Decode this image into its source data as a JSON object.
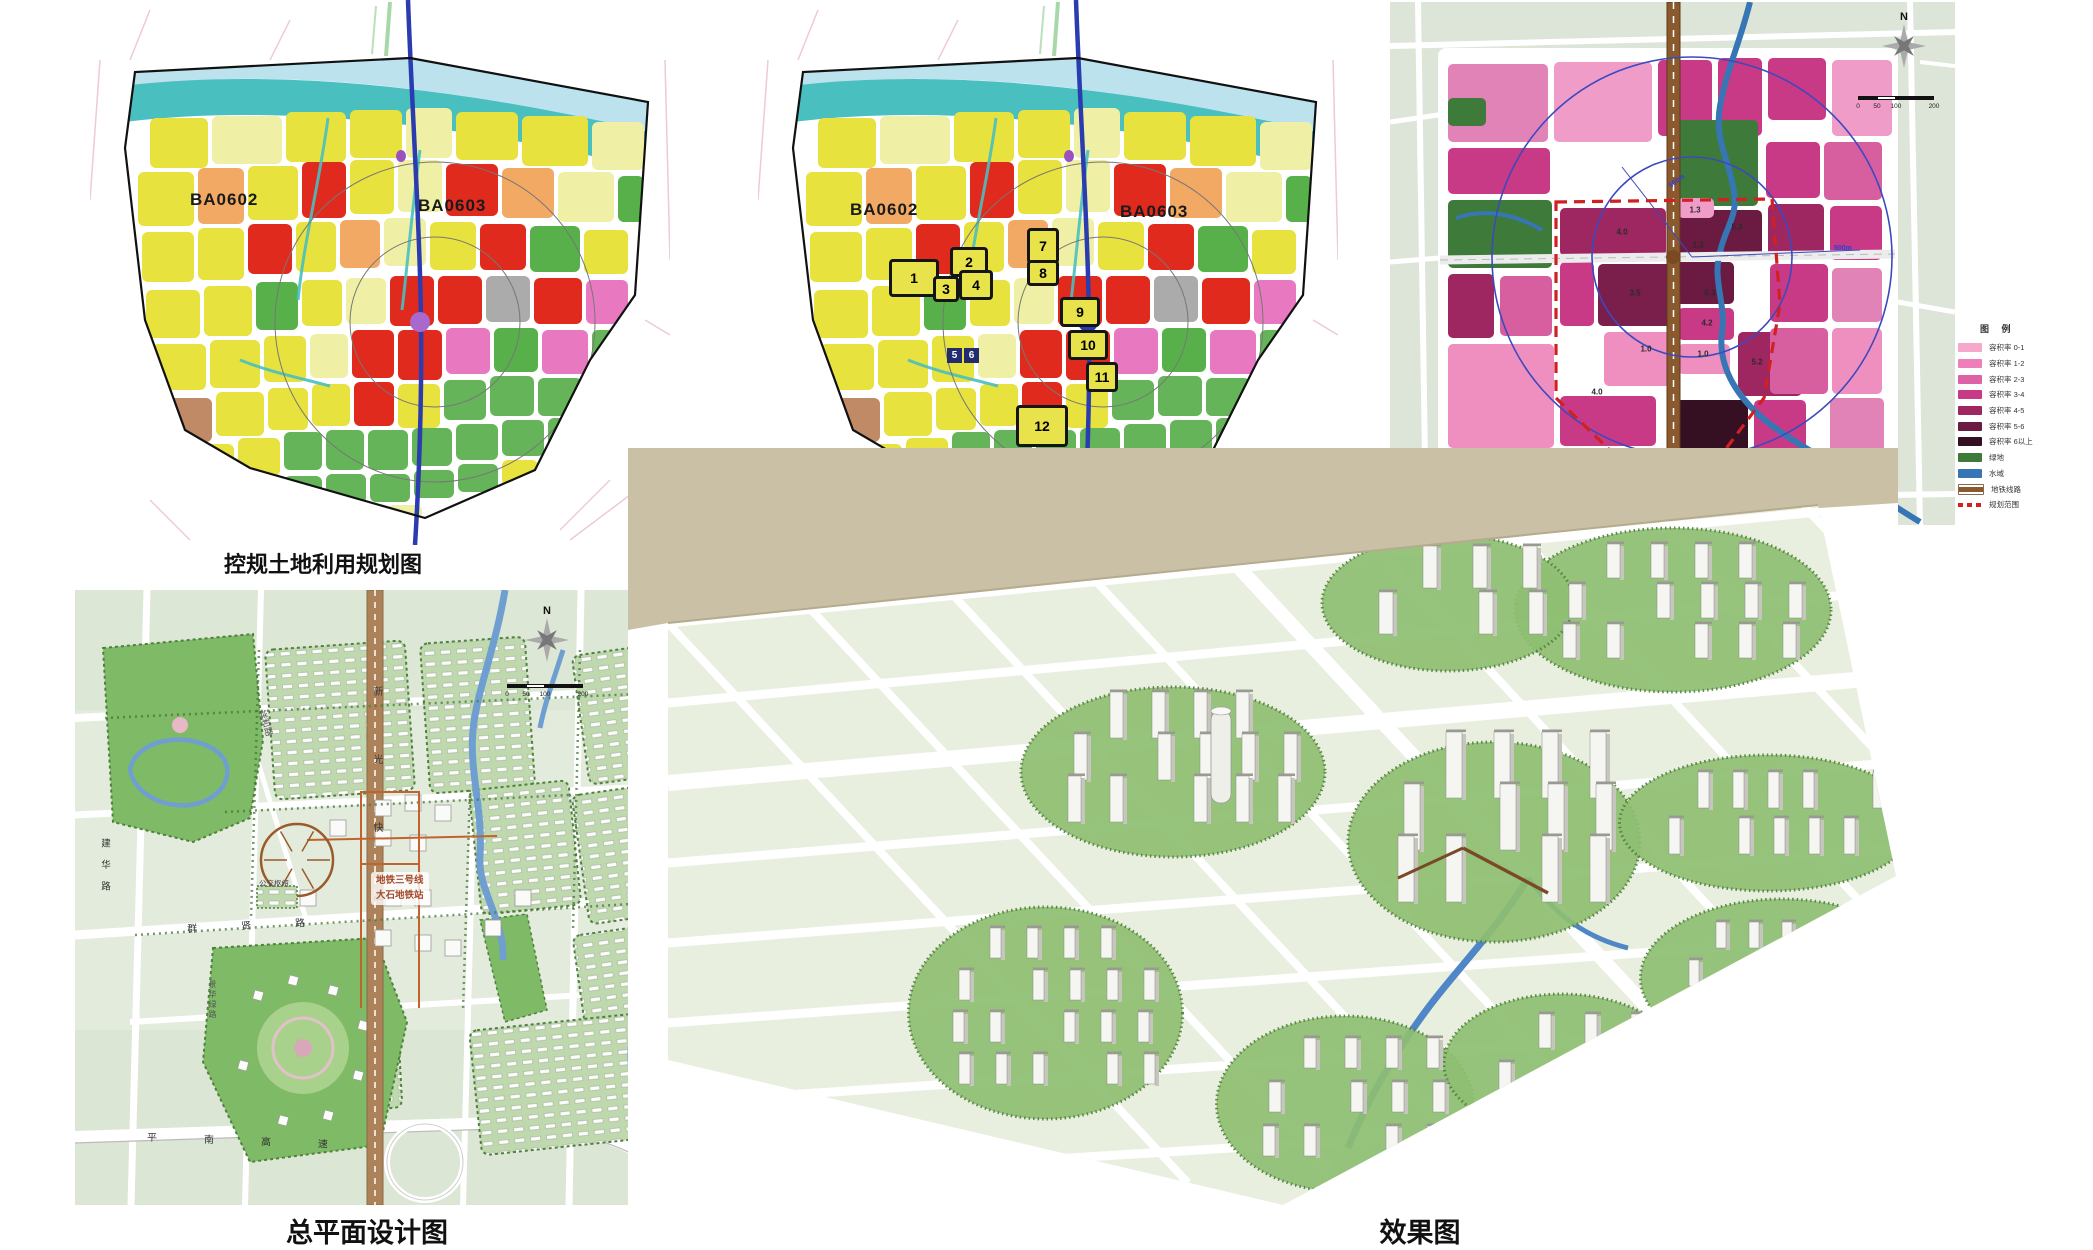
{
  "page_background": "#FFFFFF",
  "panels": {
    "regulatory_plan": {
      "caption": "控规土地利用规划图",
      "block_labels": [
        "BA0602",
        "BA0603"
      ]
    },
    "urban_design_plan": {
      "caption": "城市设计土地利用规划图",
      "block_labels": [
        "BA0602",
        "BA0603"
      ],
      "parcels": [
        {
          "n": "1"
        },
        {
          "n": "2"
        },
        {
          "n": "3"
        },
        {
          "n": "4"
        },
        {
          "n": "5"
        },
        {
          "n": "6"
        },
        {
          "n": "7"
        },
        {
          "n": "8"
        },
        {
          "n": "9"
        },
        {
          "n": "10"
        },
        {
          "n": "11"
        },
        {
          "n": "12"
        }
      ]
    },
    "intensity_zoning": {
      "caption": "开发强度分区图",
      "north_label": "N",
      "scale_labels": [
        "0",
        "50",
        "100",
        "200"
      ],
      "radius_labels": [
        "500m",
        "500m"
      ],
      "far_labels": [
        {
          "value": "4.0"
        },
        {
          "value": "5.3"
        },
        {
          "value": "1.3"
        },
        {
          "value": "1.3"
        },
        {
          "value": "3.5"
        },
        {
          "value": "5.3"
        },
        {
          "value": "4.2"
        },
        {
          "value": "1.0"
        },
        {
          "value": "1.0"
        },
        {
          "value": "5.2"
        },
        {
          "value": "4.0"
        }
      ],
      "legend": {
        "title": "图 例",
        "items": [
          {
            "label": "容积率 0-1",
            "color": "#F5A8CC",
            "style": "fill"
          },
          {
            "label": "容积率 1-2",
            "color": "#EF7FB8",
            "style": "fill"
          },
          {
            "label": "容积率 2-3",
            "color": "#DE62A6",
            "style": "fill"
          },
          {
            "label": "容积率 3-4",
            "color": "#C93A86",
            "style": "fill"
          },
          {
            "label": "容积率 4-5",
            "color": "#9E2762",
            "style": "fill"
          },
          {
            "label": "容积率 5-6",
            "color": "#6B1A41",
            "style": "fill"
          },
          {
            "label": "容积率 6以上",
            "color": "#351022",
            "style": "fill"
          },
          {
            "label": "绿地",
            "color": "#3E7A39",
            "style": "fill"
          },
          {
            "label": "水域",
            "color": "#3776B5",
            "style": "fill"
          },
          {
            "label": "地铁线路",
            "color": "#8A5A2E",
            "style": "line"
          },
          {
            "label": "规划范围",
            "color": "#CF2121",
            "style": "dashed"
          }
        ]
      }
    },
    "master_plan": {
      "caption": "总平面设计图",
      "north_label": "N",
      "scale_labels": [
        "0",
        "50",
        "100",
        "200"
      ],
      "road_labels": {
        "expressway": "新光快速",
        "jianhua": "建华路",
        "xianghe": "祥和路",
        "qunxian": "群贤路",
        "pingnan": "平南高速",
        "jinghua": "景华绿路"
      },
      "station": {
        "line_label": "地铁三号线",
        "station_label": "大石地铁站"
      },
      "hub_label": "公交枢纽"
    },
    "rendering": {
      "caption": "效果图"
    }
  },
  "colors": {
    "land_use": {
      "residential_yellow": "#E8E23F",
      "pale_yellow": "#EFF0A6",
      "commercial_red": "#E02A1E",
      "green_space": "#57B04A",
      "south_green": "#66B45A",
      "orange": "#F2A963",
      "pink": "#E878C0",
      "purple": "#9B50C0",
      "gray": "#ABABAB",
      "brown": "#C18A66",
      "small_blue": "#4053C0",
      "river_teal": "#49BFC0",
      "river_pale": "#BCE2EE",
      "metro_blue": "#2B3CB0",
      "station_purple": "#A868CC"
    },
    "intensity": {
      "far_0_1": "#F5A8CC",
      "far_1_2": "#EF7FB8",
      "far_2_3": "#DE62A6",
      "far_3_4": "#C93A86",
      "far_4_5": "#9E2762",
      "far_5_6": "#6B1A41",
      "far_6_plus": "#351022",
      "green": "#3E7A39",
      "water": "#3776B5",
      "metro_brown": "#8A5A2E",
      "boundary_red": "#CF2121",
      "circle_blue": "#3C49BE"
    }
  }
}
